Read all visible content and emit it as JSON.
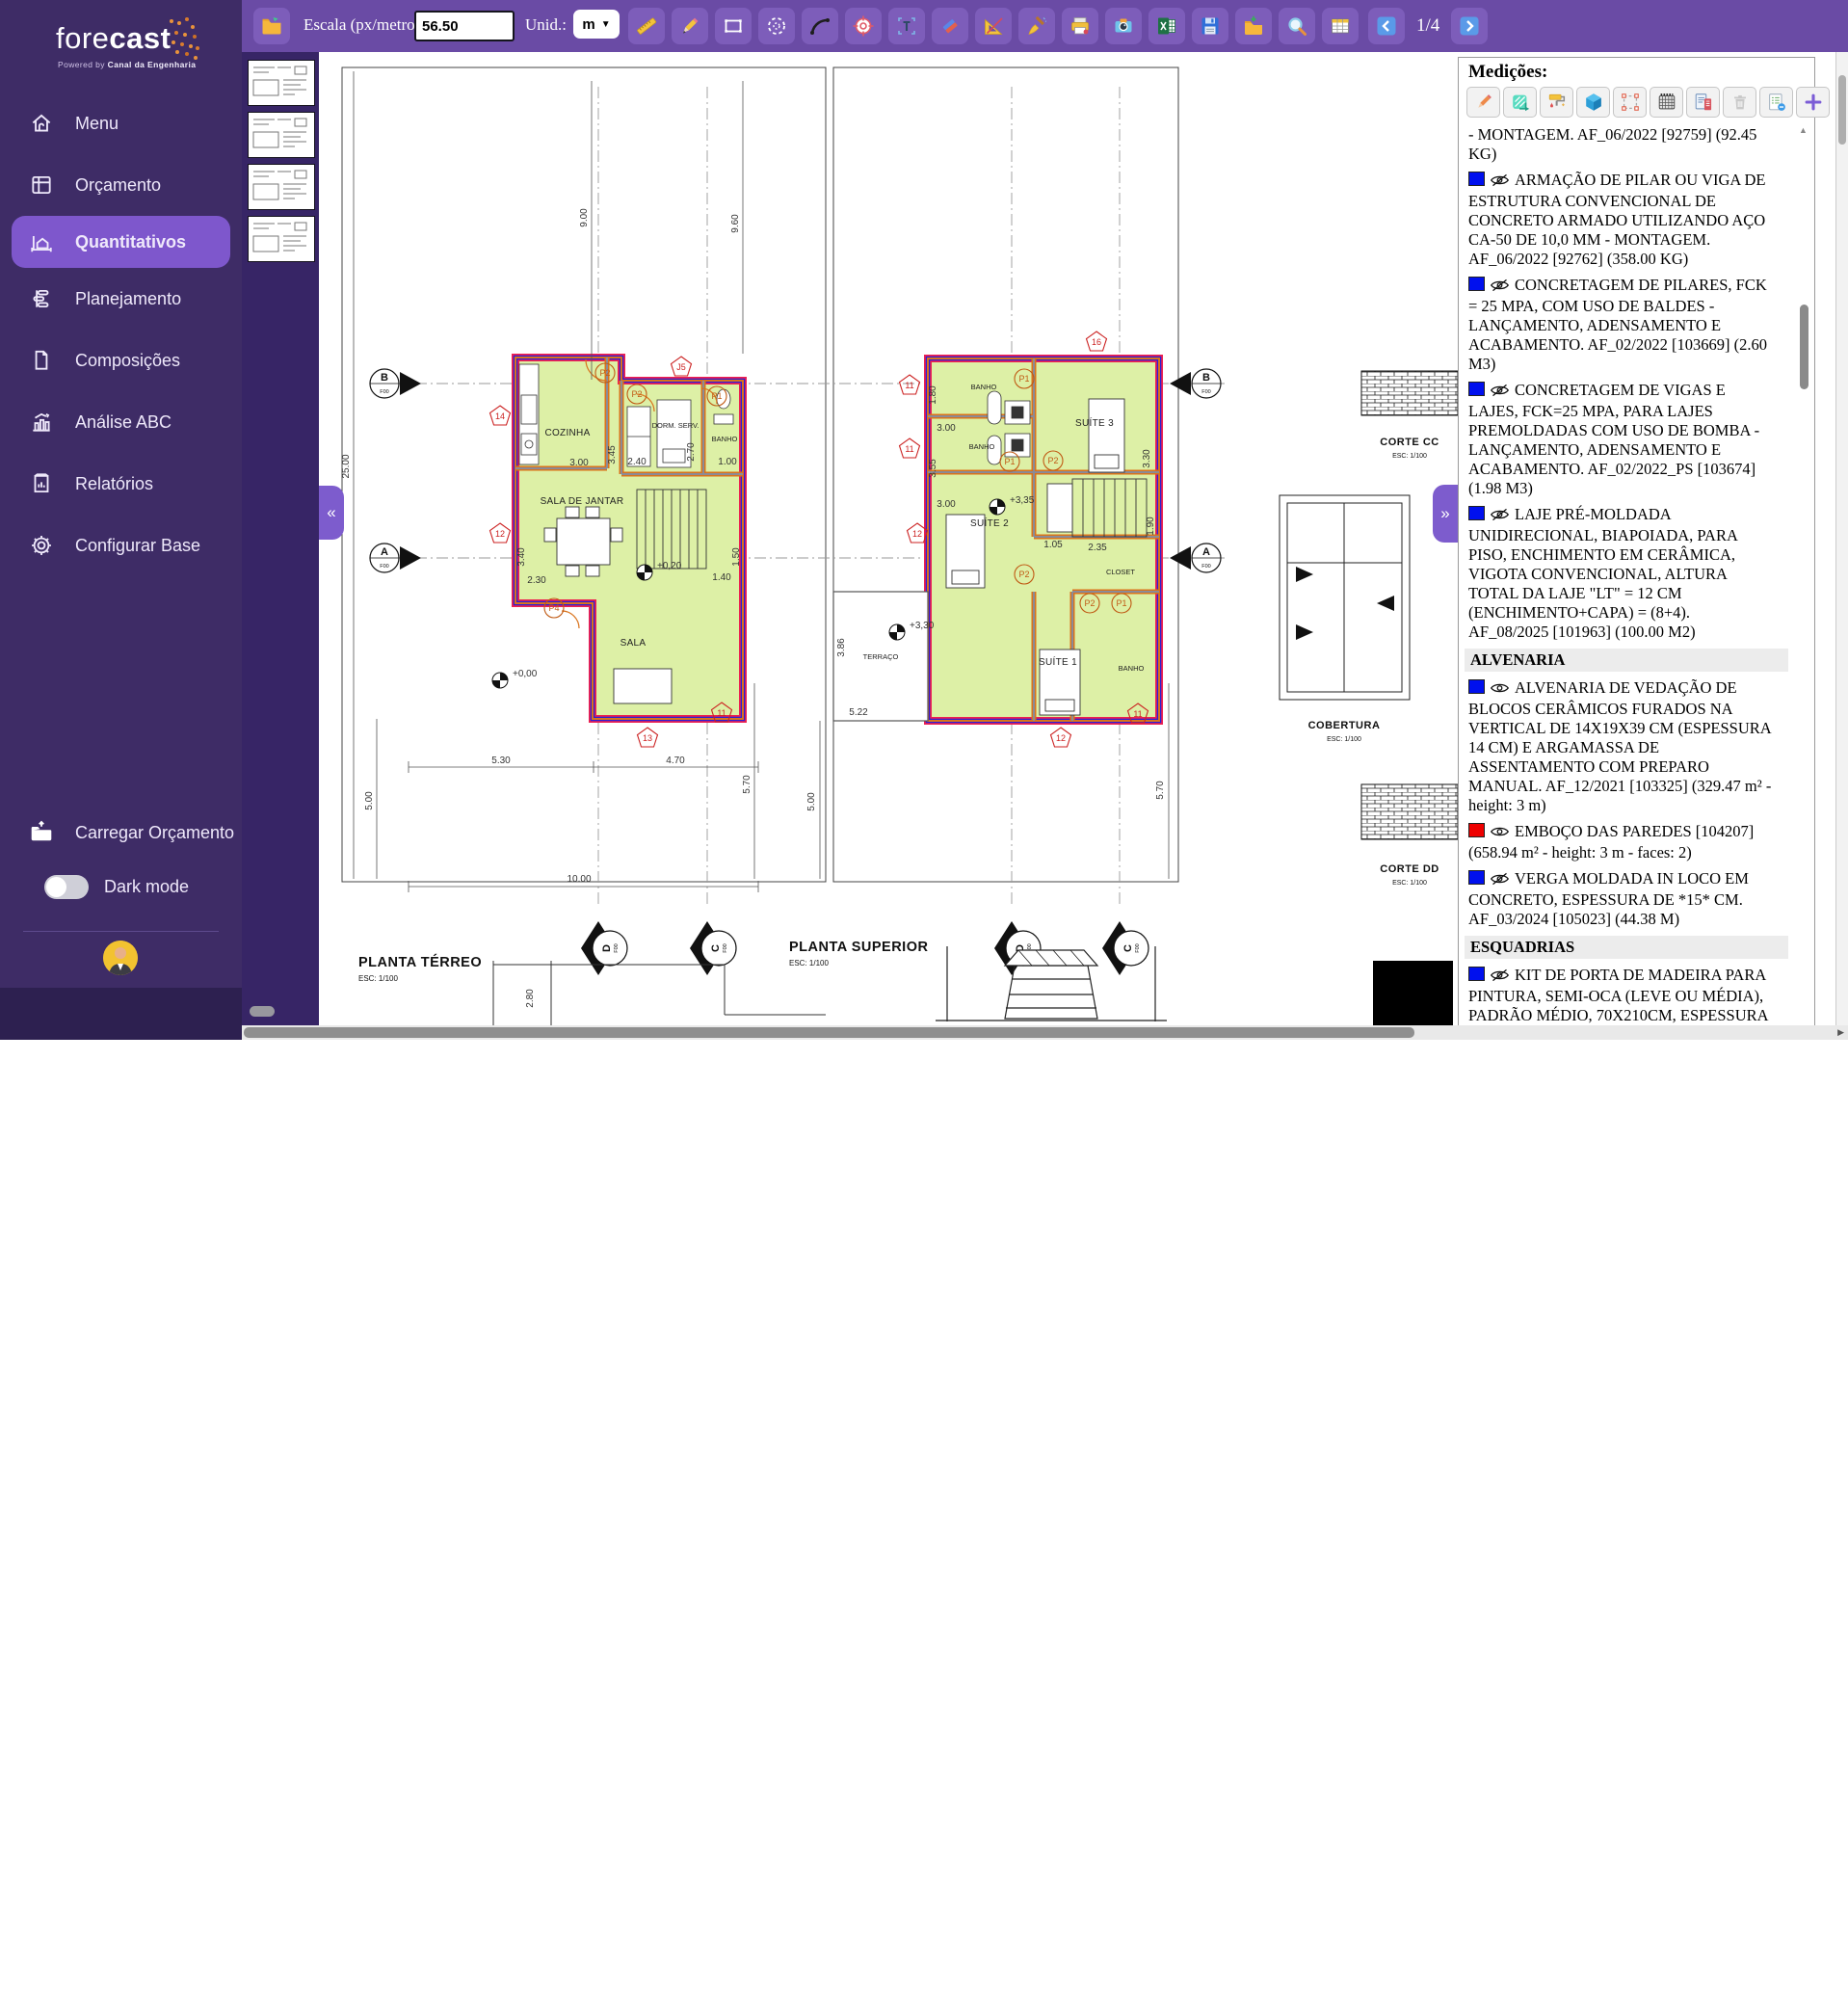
{
  "app": {
    "brand_light": "fore",
    "brand_bold": "cast",
    "tagline_prefix": "Powered by",
    "tagline_brand": "Canal da Engenharia",
    "accent_color": "#7e57cc",
    "sidebar_color": "#3e2c66",
    "toolbar_color": "#6a4ba5"
  },
  "sidebar": {
    "items": [
      {
        "label": "Menu",
        "icon": "home-icon",
        "active": false
      },
      {
        "label": "Orçamento",
        "icon": "budget-icon",
        "active": false
      },
      {
        "label": "Quantitativos",
        "icon": "quantities-icon",
        "active": true
      },
      {
        "label": "Planejamento",
        "icon": "planning-icon",
        "active": false
      },
      {
        "label": "Composições",
        "icon": "compositions-icon",
        "active": false
      },
      {
        "label": "Análise ABC",
        "icon": "abc-analysis-icon",
        "active": false
      },
      {
        "label": "Relatórios",
        "icon": "reports-icon",
        "active": false
      },
      {
        "label": "Configurar Base",
        "icon": "gear-icon",
        "active": false
      }
    ],
    "load_budget_label": "Carregar Orçamento",
    "dark_mode_label": "Dark mode"
  },
  "toolbar": {
    "scale_label": "Escala (px/metro):",
    "scale_value": "56.50",
    "unit_label": "Unid.:",
    "unit_value": "m",
    "page_indicator": "1/4",
    "tools": [
      {
        "name": "ruler"
      },
      {
        "name": "pencil"
      },
      {
        "name": "rect-select"
      },
      {
        "name": "ellipse-select"
      },
      {
        "name": "curve"
      },
      {
        "name": "target"
      },
      {
        "name": "text-tool"
      },
      {
        "name": "eraser"
      },
      {
        "name": "set-square"
      },
      {
        "name": "broom"
      },
      {
        "name": "printer"
      },
      {
        "name": "camera"
      },
      {
        "name": "excel-export"
      },
      {
        "name": "save"
      },
      {
        "name": "import-folder"
      },
      {
        "name": "zoom"
      },
      {
        "name": "table"
      }
    ]
  },
  "thumbnails": [
    {
      "name": "page-1"
    },
    {
      "name": "page-2"
    },
    {
      "name": "page-3"
    },
    {
      "name": "page-4"
    }
  ],
  "measurements": {
    "title": "Medições:",
    "tools": [
      {
        "name": "edit"
      },
      {
        "name": "area"
      },
      {
        "name": "paint-roller"
      },
      {
        "name": "volume"
      },
      {
        "name": "select-region"
      },
      {
        "name": "count-grid"
      },
      {
        "name": "report-export"
      },
      {
        "name": "trash"
      },
      {
        "name": "list-badge"
      },
      {
        "name": "add"
      }
    ],
    "items": [
      {
        "color": null,
        "visible": null,
        "text": "- MONTAGEM. AF_06/2022 [92759] (92.45 KG)"
      },
      {
        "color": "#0010ee",
        "visible": false,
        "text": "ARMAÇÃO DE PILAR OU VIGA DE ESTRUTURA CONVENCIONAL DE CONCRETO ARMADO UTILIZANDO AÇO CA-50 DE 10,0 MM - MONTAGEM. AF_06/2022 [92762] (358.00 KG)"
      },
      {
        "color": "#0010ee",
        "visible": false,
        "text": "CONCRETAGEM DE PILARES, FCK = 25 MPA, COM USO DE BALDES - LANÇAMENTO, ADENSAMENTO E ACABAMENTO. AF_02/2022 [103669] (2.60 M3)"
      },
      {
        "color": "#0010ee",
        "visible": false,
        "text": "CONCRETAGEM DE VIGAS E LAJES, FCK=25 MPA, PARA LAJES PREMOLDADAS COM USO DE BOMBA - LANÇAMENTO, ADENSAMENTO E ACABAMENTO. AF_02/2022_PS [103674] (1.98 M3)"
      },
      {
        "color": "#0010ee",
        "visible": false,
        "text": "LAJE PRÉ-MOLDADA UNIDIRECIONAL, BIAPOIADA, PARA PISO, ENCHIMENTO EM CERÂMICA, VIGOTA CONVENCIONAL, ALTURA TOTAL DA LAJE \"LT\" = 12 CM (ENCHIMENTO+CAPA) = (8+4). AF_08/2025 [101963] (100.00 M2)"
      },
      {
        "section": "ALVENARIA"
      },
      {
        "color": "#0010ee",
        "visible": true,
        "text": "ALVENARIA DE VEDAÇÃO DE BLOCOS CERÂMICOS FURADOS NA VERTICAL DE 14X19X39 CM (ESPESSURA 14 CM) E ARGAMASSA DE ASSENTAMENTO COM PREPARO MANUAL. AF_12/2021 [103325] (329.47 m² - height: 3 m)"
      },
      {
        "color": "#ee0000",
        "visible": true,
        "text": "EMBOÇO DAS PAREDES [104207] (658.94 m² - height: 3 m - faces: 2)"
      },
      {
        "color": "#0010ee",
        "visible": false,
        "text": "VERGA MOLDADA IN LOCO EM CONCRETO, ESPESSURA DE *15* CM. AF_03/2024 [105023] (44.38 M)"
      },
      {
        "section": "ESQUADRIAS"
      },
      {
        "color": "#0010ee",
        "visible": false,
        "text": "KIT DE PORTA DE MADEIRA PARA PINTURA, SEMI-OCA (LEVE OU MÉDIA), PADRÃO MÉDIO, 70X210CM, ESPESSURA DE 3,5CM, ITENS INCLUSOS: DOBRADIÇAS, MONTAGEM E INSTALAÇÃO DO BATENTE, SEM FECHADURA - FORNECIMENTO E INSTALAÇÃO. AF_12/2019 [90848] (3.00 UN)"
      },
      {
        "color": "#0010ee",
        "visible": false,
        "text": "KIT DE PORTA DE MADEIRA PARA PINTURA, SEMI-OCA (LEVE OU MÉDIA), PADRÃO MÉDIO, 80X210CM, ESPESSURA DE 3,5CM, ITENS INCLUSOS: DOBRADIÇAS, MONTAGEM E INSTALAÇÃO DO BATENTE,"
      }
    ]
  },
  "canvas": {
    "terreo": {
      "title": "PLANTA TÉRREO",
      "esc": "ESC: 1/100",
      "cozinha": "COZINHA",
      "dorm": "DORM. SERV.",
      "banho": "BANHO",
      "sala_jantar": "SALA DE JANTAR",
      "sala": "SALA",
      "lv0": "+0,00",
      "lv20": "+0,20",
      "d900": "9.00",
      "d960": "9.60",
      "d2500": "25.00",
      "d500": "5.00",
      "d570": "5.70",
      "d530": "5.30",
      "d470": "4.70",
      "d1000": "10.00",
      "d300": "3.00",
      "d345": "3.45",
      "d240": "2.40",
      "d270": "2.70",
      "d100": "1.00",
      "d230": "2.30",
      "d340": "3.40",
      "d140": "1.40",
      "d150": "1.50",
      "d280": "2.80",
      "p1": "P1",
      "p2": "P2",
      "p4": "P4",
      "j5": "J5",
      "t14": "14",
      "t12": "12",
      "t11": "11",
      "t13": "13"
    },
    "superior": {
      "title": "PLANTA SUPERIOR",
      "esc": "ESC: 1/100",
      "banho": "BANHO",
      "suite1": "SUÍTE 1",
      "suite2": "SUÍTE 2",
      "suite3": "SUÍTE 3",
      "closet": "CLOSET",
      "terraco": "TERRAÇO",
      "lv330": "+3,30",
      "lv335": "+3,35",
      "d500": "5.00",
      "d570": "5.70",
      "d522": "5.22",
      "d386": "3.86",
      "d105": "1.05",
      "d235": "2.35",
      "d190": "1.90",
      "d330": "3.30",
      "d355": "3.55",
      "d300": "3.00",
      "d180": "1.80",
      "p1": "P1",
      "p2": "P2",
      "t16": "16",
      "t11": "11",
      "t12": "12"
    },
    "side": {
      "corte_cc": "CORTE CC",
      "corte_dd": "CORTE DD",
      "cobertura": "COBERTURA",
      "esc": "ESC: 1/100"
    },
    "axes": {
      "a": "A",
      "b": "B",
      "c": "C",
      "d": "D",
      "f00": "F00"
    },
    "highlight_fill": "#ddf0a6",
    "wall_color": "#d9731c",
    "outline_blue": "#2b1fd4",
    "outline_red": "#ee2050"
  }
}
